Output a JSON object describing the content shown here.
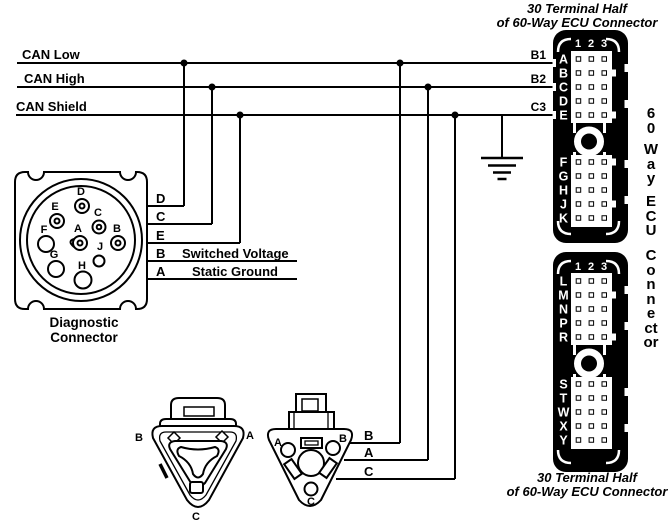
{
  "colors": {
    "ink": "#000000",
    "paper": "#ffffff"
  },
  "captions": {
    "ecu_top": {
      "line1": "30 Terminal Half",
      "line2": "of 60-Way ECU Connector"
    },
    "ecu_bottom": {
      "line1": "30 Terminal Half",
      "line2": "of 60-Way ECU Connector"
    },
    "diagnostic": {
      "line1": "Diagnostic",
      "line2": "Connector"
    }
  },
  "bus": {
    "can_low": "CAN Low",
    "can_high": "CAN High",
    "can_shield": "CAN Shield"
  },
  "ecu_terminals": {
    "b1": "B1",
    "b2": "B2",
    "c3": "C3"
  },
  "diagnostic_pins": {
    "a": "A",
    "b": "B",
    "c": "C",
    "d": "D",
    "e": "E",
    "f": "F",
    "g": "G",
    "h": "H",
    "j": "J"
  },
  "diagnostic_wires": {
    "d": "D",
    "c": "C",
    "e": "E",
    "b": "B",
    "a": "A",
    "switched_voltage": "Switched Voltage",
    "static_ground": "Static Ground"
  },
  "ecu_connector": {
    "columns": [
      "1",
      "2",
      "3"
    ],
    "half1_rows_top": [
      "A",
      "B",
      "C",
      "D",
      "E"
    ],
    "half1_rows_bottom": [
      "F",
      "G",
      "H",
      "J",
      "K"
    ],
    "half2_rows_top": [
      "L",
      "M",
      "N",
      "P",
      "R"
    ],
    "half2_rows_bottom": [
      "S",
      "T",
      "W",
      "X",
      "Y"
    ],
    "side_label": {
      "g1": "60",
      "g2": "Way",
      "g3": "ECU",
      "g4": "Connector"
    }
  },
  "triangle_left": {
    "a": "A",
    "b": "B",
    "c": "C"
  },
  "triangle_right": {
    "pins": {
      "a": "A",
      "b": "B",
      "c": "C"
    },
    "wires": {
      "b": "B",
      "a": "A",
      "c": "C"
    }
  }
}
